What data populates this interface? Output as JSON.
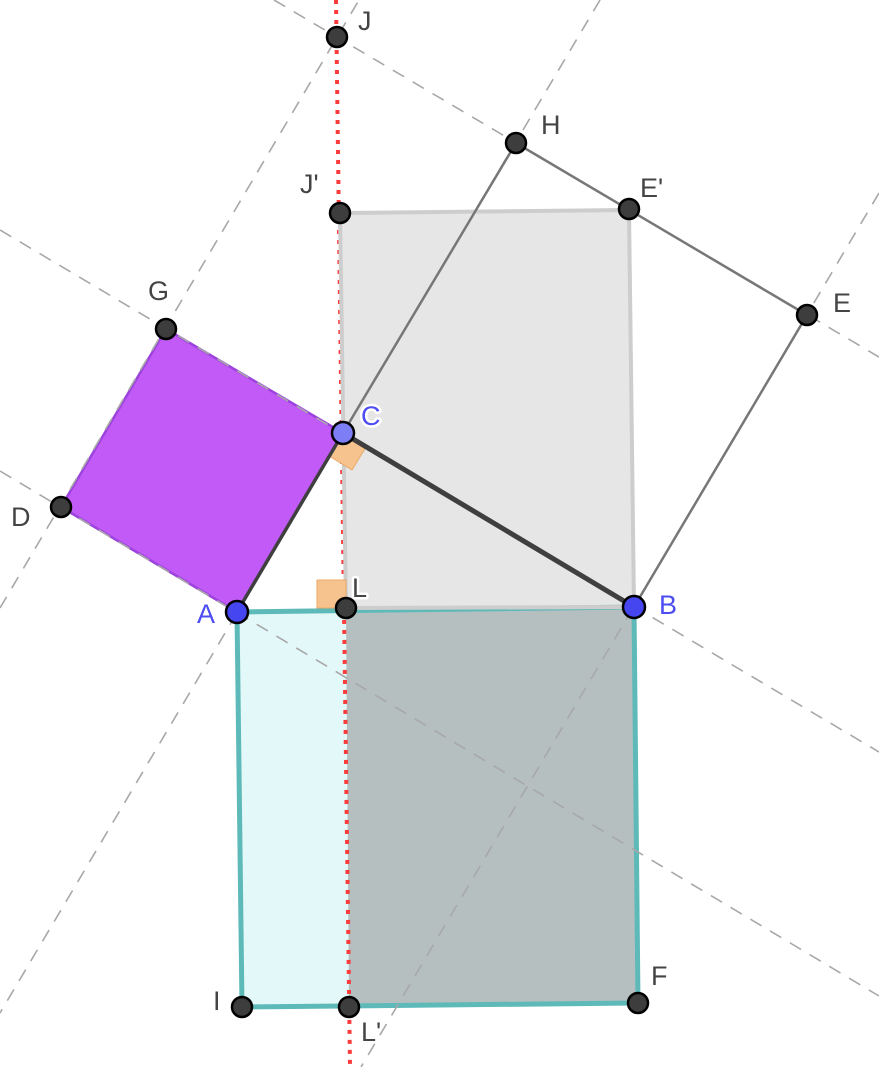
{
  "figure": {
    "description_labels_only": "Pythagorean theorem construction",
    "colors": {
      "background": "#FFFFFF",
      "leg_square_AC_fill": "#C15AF6",
      "leg_square_AC_border": "#9C43DD",
      "hyp_square_AB_border": "#5EB9B9",
      "hyp_square_AB_fill": "#E3F8F8",
      "overlap_rectangle_fill": "#B5BFBF",
      "sheared_rectangle_fill": "#C8C8C8",
      "sheared_rectangle_border": "#CDCDCD",
      "leg_square_CB_outline": "#777777",
      "triangle_sides": "#3F3F3F",
      "dashed_lines": "#A8A8A8",
      "altitude_line": "#F93B3B",
      "right_angle_marker": "#F6C28E",
      "label_dark": "#444444",
      "label_blue": "#4D4DF3",
      "point_dark": "#3D3D3D",
      "point_blue": "#4646F0",
      "point_light_blue": "#7D7DF5"
    }
  },
  "points": [
    {
      "label": "J",
      "x": 337,
      "y": 37,
      "label_x": 358,
      "label_y": 30
    },
    {
      "label": "H",
      "x": 516,
      "y": 143,
      "label_x": 541,
      "label_y": 134
    },
    {
      "label": "E'",
      "x": 629,
      "y": 209,
      "label_x": 640,
      "label_y": 197
    },
    {
      "label": "J'",
      "x": 340,
      "y": 213,
      "label_x": 300,
      "label_y": 193
    },
    {
      "label": "E",
      "x": 807,
      "y": 315,
      "label_x": 833,
      "label_y": 312
    },
    {
      "label": "G",
      "x": 166,
      "y": 329,
      "label_x": 148,
      "label_y": 300
    },
    {
      "label": "C",
      "x": 343,
      "y": 433,
      "label_x": 361,
      "label_y": 425
    },
    {
      "label": "D",
      "x": 61,
      "y": 507,
      "label_x": 11,
      "label_y": 526
    },
    {
      "label": "A",
      "x": 237,
      "y": 612,
      "label_x": 197,
      "label_y": 623
    },
    {
      "label": "L",
      "x": 346,
      "y": 608,
      "label_x": 352,
      "label_y": 597
    },
    {
      "label": "B",
      "x": 634,
      "y": 607,
      "label_x": 659,
      "label_y": 614
    },
    {
      "label": "I",
      "x": 242,
      "y": 1007,
      "label_x": 213,
      "label_y": 1010
    },
    {
      "label": "L'",
      "x": 349,
      "y": 1007,
      "label_x": 361,
      "label_y": 1041
    },
    {
      "label": "F",
      "x": 638,
      "y": 1003,
      "label_x": 651,
      "label_y": 985
    }
  ]
}
